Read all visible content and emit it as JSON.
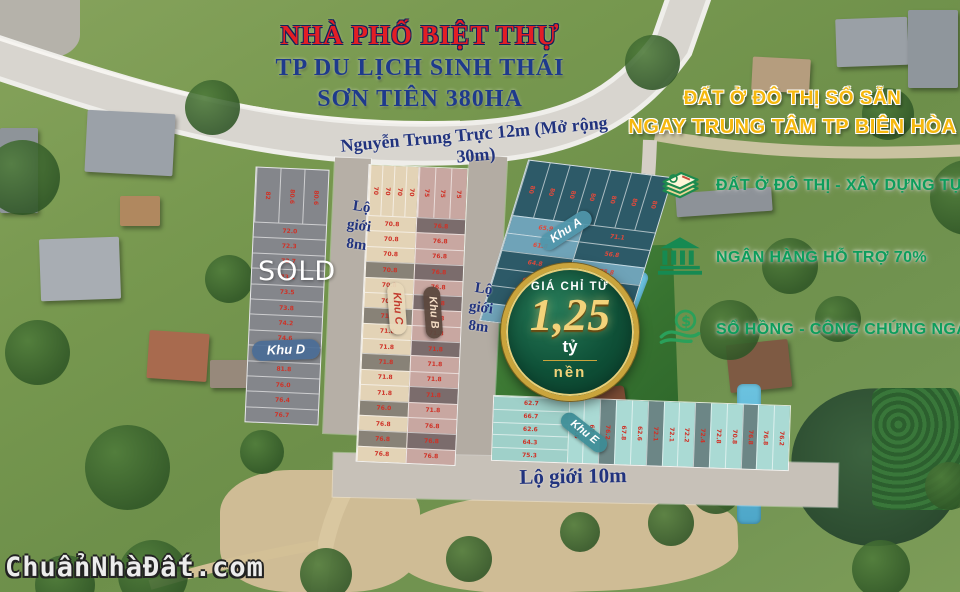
{
  "title": {
    "line1": "NHÀ PHỐ BIỆT THỰ",
    "line2": "TP DU LỊCH SINH THÁI",
    "line3": "SƠN TIÊN 380HA"
  },
  "headline": {
    "line1": "ĐẤT Ở ĐÔ THỊ SỔ SẴN",
    "line2": "NGAY TRUNG TÂM TP BIÊN HÒA"
  },
  "features": [
    {
      "icon": "deed-stack-icon",
      "label": "ĐẤT Ở ĐÔ THỊ - XÂY DỰNG TỰ DO"
    },
    {
      "icon": "bank-icon",
      "label": "NGÂN HÀNG HỖ TRỢ 70%"
    },
    {
      "icon": "money-hand-icon",
      "label": "SỔ HỒNG - CÔNG CHỨNG NGAY"
    }
  ],
  "badge": {
    "prefix": "GIÁ CHỈ TỪ",
    "price": "1,25",
    "unit": "tỷ",
    "per": "nền"
  },
  "roads": {
    "main": "Nguyễn Trung Trực 12m (Mở rộng 30m)",
    "west": "Lộ giới 8m",
    "east": "Lộ giới 8m",
    "south": "Lộ giới 10m"
  },
  "sold": "SOLD",
  "watermark": "ChuẩnNhàĐất.com",
  "colors": {
    "title_red": "#e31e25",
    "title_navy": "#1e3a8c",
    "headline_gold": "#f5b80e",
    "feature_green": "#0d9d5c",
    "badge_green": "#0f5138",
    "badge_gold": "#caa43c",
    "plot_number_red": "#cf3227"
  },
  "blocks": {
    "d": {
      "label": "Khu D",
      "top": [
        "82",
        "80.6",
        "80.6"
      ],
      "rows": [
        "72.0",
        "72.3",
        "72.7",
        "73.1",
        "73.5",
        "73.8",
        "74.2",
        "74.6",
        "74.8",
        "81.8",
        "76.0",
        "76.4",
        "76.7"
      ]
    },
    "c": {
      "label": "Khu C",
      "top": [
        "70",
        "70",
        "70",
        "70"
      ],
      "rows": [
        "70.8",
        "70.8",
        "70.8",
        {
          "a": "70.8",
          "t": "d"
        },
        "70.8",
        "70.8",
        {
          "a": "71.8",
          "t": "d"
        },
        "71.8",
        "71.8",
        {
          "a": "71.8",
          "t": "d"
        },
        "71.8",
        "71.8",
        {
          "a": "76.0",
          "t": "d"
        },
        "76.8",
        {
          "a": "76.8",
          "t": "d"
        },
        "76.8"
      ]
    },
    "b": {
      "label": "Khu B",
      "top": [
        "75",
        "75",
        "75"
      ],
      "rows": [
        {
          "a": "76.8",
          "t": "d"
        },
        "76.8",
        "76.8",
        {
          "a": "76.8",
          "t": "d"
        },
        "76.8",
        {
          "a": "76.8",
          "t": "d"
        },
        "71.8",
        "71.8",
        {
          "a": "71.8",
          "t": "d"
        },
        "71.8",
        "71.8",
        {
          "a": "71.8",
          "t": "d"
        },
        "71.8",
        "76.8",
        {
          "a": "76.8",
          "t": "d"
        },
        "76.8"
      ]
    },
    "a": {
      "label": "Khu A",
      "top": [
        "80",
        "80",
        "80",
        "80",
        "80",
        "80",
        "80"
      ],
      "left": [
        {
          "a": "65.9",
          "t": "l"
        },
        {
          "a": "61.8",
          "t": "l"
        },
        "64.8",
        "66.5",
        "64.1",
        {
          "a": "62.8",
          "t": "l"
        }
      ],
      "right": [
        "71.1",
        "56.8",
        {
          "a": "75.8",
          "t": "l"
        },
        "63.2",
        {
          "a": "65.1",
          "t": "l"
        },
        "64.1"
      ]
    },
    "e": {
      "label": "Khu E",
      "left": [
        "62.7",
        "66.7",
        "62.6",
        "64.3",
        "75.3"
      ],
      "strip": [
        "70.6",
        "67.8",
        {
          "a": "76.2",
          "t": "d"
        },
        "67.8",
        "62.6",
        {
          "a": "72.1",
          "t": "d"
        },
        "72.1",
        "72.2",
        {
          "a": "72.4",
          "t": "d"
        },
        "72.8",
        "70.8",
        {
          "a": "76.8",
          "t": "d"
        },
        "76.8",
        "76.2"
      ]
    }
  }
}
